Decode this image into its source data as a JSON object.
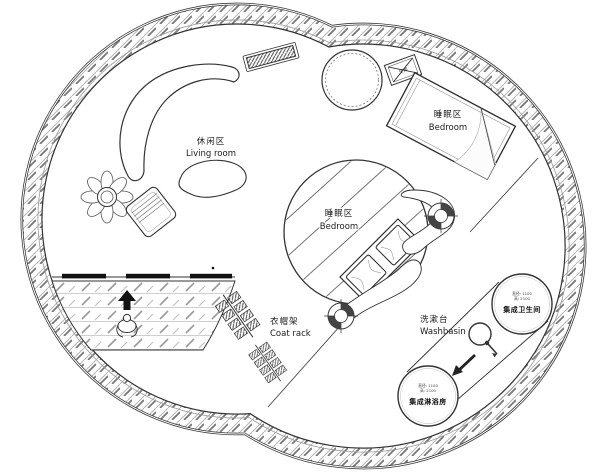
{
  "plan": {
    "areas": {
      "living_room": {
        "zh": "休闲区",
        "en": "Living room"
      },
      "bedroom_core": {
        "zh": "睡眠区",
        "en": "Bedroom"
      },
      "bedroom_upper": {
        "zh": "睡眠区",
        "en": "Bedroom"
      },
      "coat_rack": {
        "zh": "衣帽架",
        "en": "Coat rack"
      },
      "washbasin": {
        "zh": "洗漱台",
        "en": "Washbasin"
      }
    },
    "pods": {
      "toilet": {
        "name": "集成卫生间",
        "dim1": "直径: 1100",
        "dim2": "高: 2100"
      },
      "shower": {
        "name": "集成淋浴房",
        "dim1": "直径: 1100",
        "dim2": "高: 2100"
      }
    },
    "equipment": {
      "ac": "空调"
    },
    "colors": {
      "line": "#333333",
      "wall_hatch_light": "#b4b4b4",
      "wall_hatch_dark": "#777777",
      "glass": "#111111",
      "background": "#ffffff"
    }
  }
}
